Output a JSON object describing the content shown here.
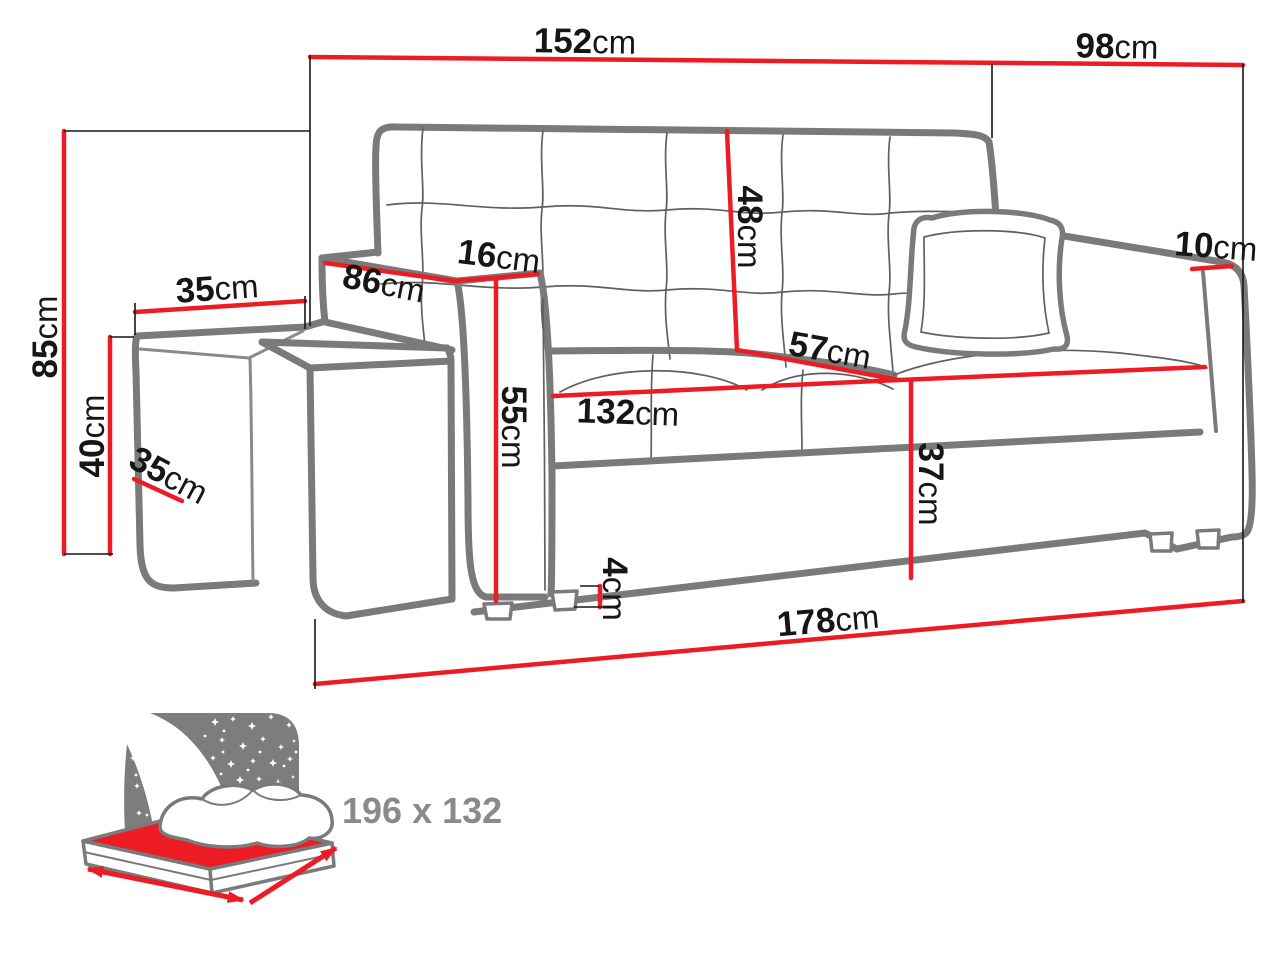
{
  "diagram": {
    "dims": [
      {
        "name": "back-section-width",
        "num": "152",
        "unit": "cm"
      },
      {
        "name": "right-section-width",
        "num": "98",
        "unit": "cm"
      },
      {
        "name": "overall-height",
        "num": "85",
        "unit": "cm"
      },
      {
        "name": "pouf-width",
        "num": "35",
        "unit": "cm"
      },
      {
        "name": "pouf-height",
        "num": "40",
        "unit": "cm"
      },
      {
        "name": "pouf-depth",
        "num": "35",
        "unit": "cm"
      },
      {
        "name": "armrest-depth",
        "num": "86",
        "unit": "cm"
      },
      {
        "name": "armrest-width",
        "num": "16",
        "unit": "cm"
      },
      {
        "name": "armrest-height",
        "num": "55",
        "unit": "cm"
      },
      {
        "name": "backrest-height",
        "num": "48",
        "unit": "cm"
      },
      {
        "name": "seat-depth",
        "num": "57",
        "unit": "cm"
      },
      {
        "name": "seat-width",
        "num": "132",
        "unit": "cm"
      },
      {
        "name": "seat-height",
        "num": "37",
        "unit": "cm"
      },
      {
        "name": "right-armrest-top-width",
        "num": "10",
        "unit": "cm"
      },
      {
        "name": "leg-height",
        "num": "4",
        "unit": "cm"
      },
      {
        "name": "overall-length",
        "num": "178",
        "unit": "cm"
      }
    ],
    "bed_icon": {
      "size_label": "196 x 132"
    },
    "colors": {
      "dimension_red": "#ed1c24",
      "sofa_line_grey": "#7a7a7a",
      "text_black": "#161616",
      "icon_grey": "#7d7d7d",
      "icon_text_grey": "#8a8a8a"
    }
  }
}
